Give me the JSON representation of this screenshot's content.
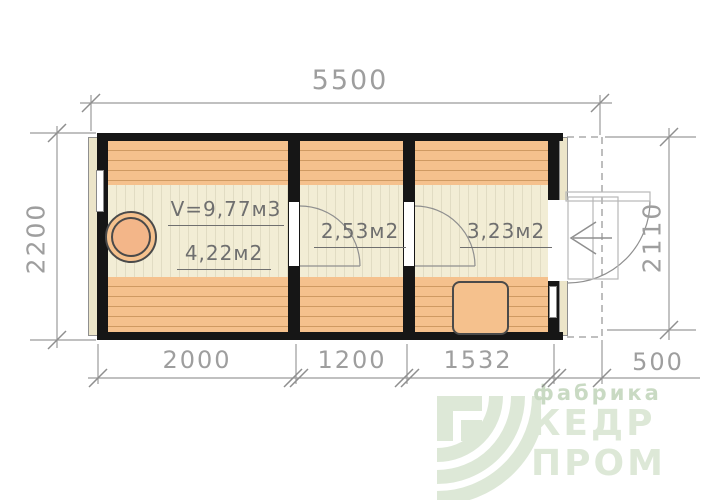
{
  "plan": {
    "dimensions": {
      "top": "5500",
      "left": "2200",
      "right": "2110",
      "bottom": [
        "2000",
        "1200",
        "1532",
        "500"
      ]
    },
    "rooms": [
      {
        "volume": "V=9,77м3",
        "area": "4,22м2"
      },
      {
        "area": "2,53м2"
      },
      {
        "area": "3,23м2"
      }
    ]
  },
  "logo": {
    "tagline": "фабрика",
    "line1": "КЕДР",
    "line2": "ПРОМ"
  },
  "colors": {
    "wall": "#161616",
    "bench_orange": "#f5c18d",
    "floor_cream": "#f2edd5",
    "line_gray": "#9b9b9b",
    "label_gray": "#6f6f6f",
    "logo_green": "#dde8d7"
  }
}
